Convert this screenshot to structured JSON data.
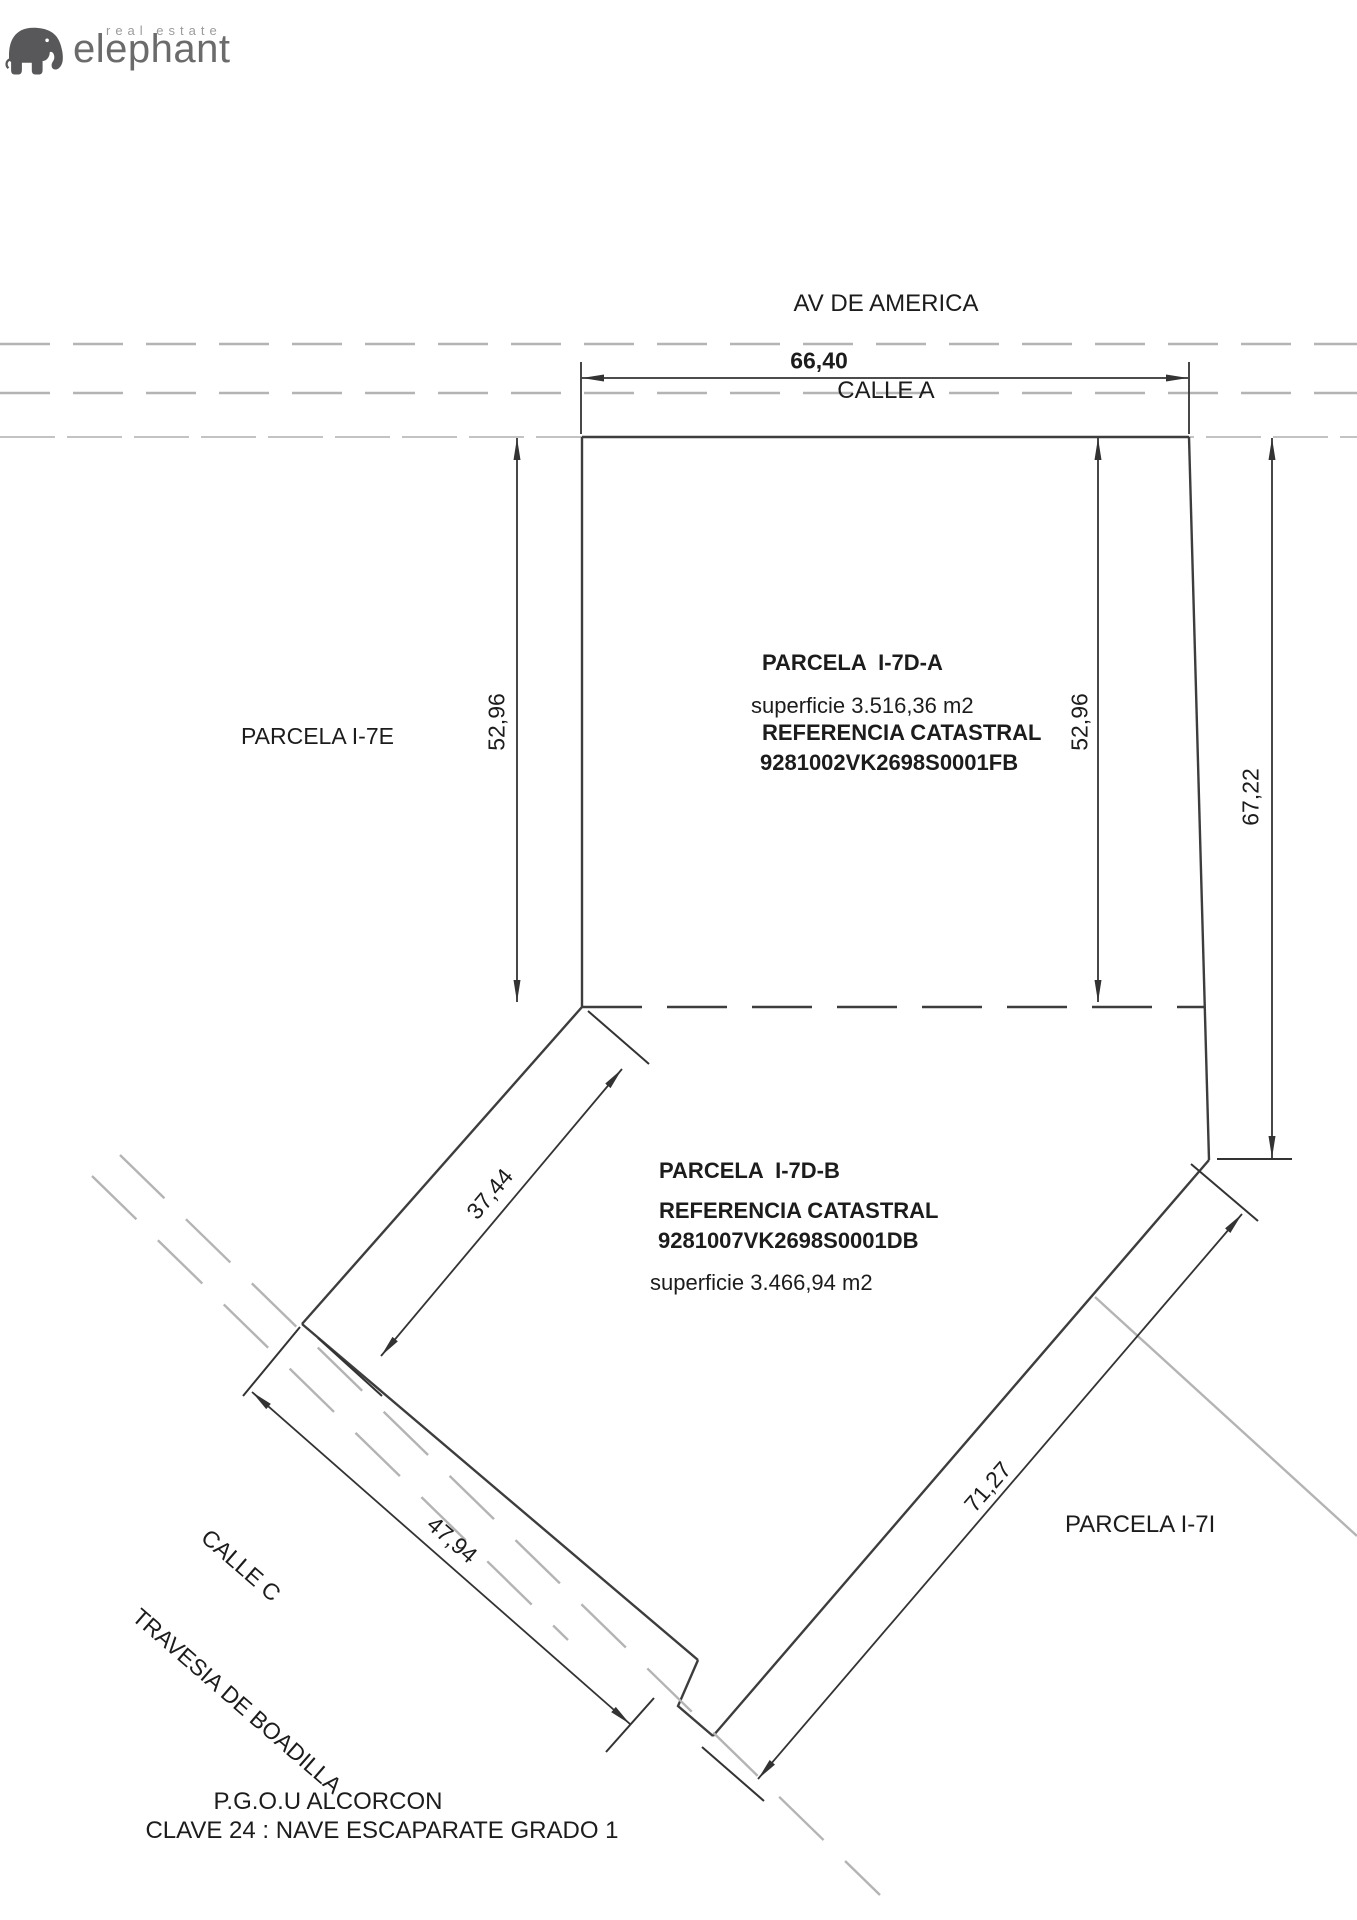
{
  "header": {
    "brand_small": "real estate",
    "brand_name": "elephant"
  },
  "top_street": {
    "line1": "AV DE AMERICA",
    "line2": "CALLE A"
  },
  "parcels": {
    "i7e_label": "PARCELA I-7E",
    "i7i_label": "PARCELA I-7I",
    "a": {
      "title": "PARCELA  I-7D-A",
      "superficie": "superficie 3.516,36 m2",
      "ref_label": "REFERENCIA CATASTRAL",
      "ref_value": "9281002VK2698S0001FB"
    },
    "b": {
      "title": "PARCELA  I-7D-B",
      "ref_label": "REFERENCIA CATASTRAL",
      "ref_value": "9281007VK2698S0001DB",
      "superficie": "superficie 3.466,94 m2"
    }
  },
  "dimensions": {
    "top_width": "66,40",
    "left_depth": "52,96",
    "right_depth": "52,96",
    "right_total": "67,22",
    "nw_edge": "37,44",
    "sw_edge": "47,94",
    "se_edge": "71,27"
  },
  "street_c": {
    "line1": "CALLE C",
    "line2": "TRAVESIA DE BOADILLA"
  },
  "footer": {
    "line1": "P.G.O.U ALCORCON",
    "line2": "CLAVE 24 : NAVE ESCAPARATE GRADO 1"
  },
  "colors": {
    "line_dark": "#3d3d3d",
    "line_dim": "#333333",
    "line_gray": "#b4b4b4",
    "line_light": "#c3c3c3",
    "text": "#1c1c1c",
    "logo_gray": "#58585a",
    "logo_text": "#6b6b6b",
    "logo_small": "#9b9b9b"
  }
}
